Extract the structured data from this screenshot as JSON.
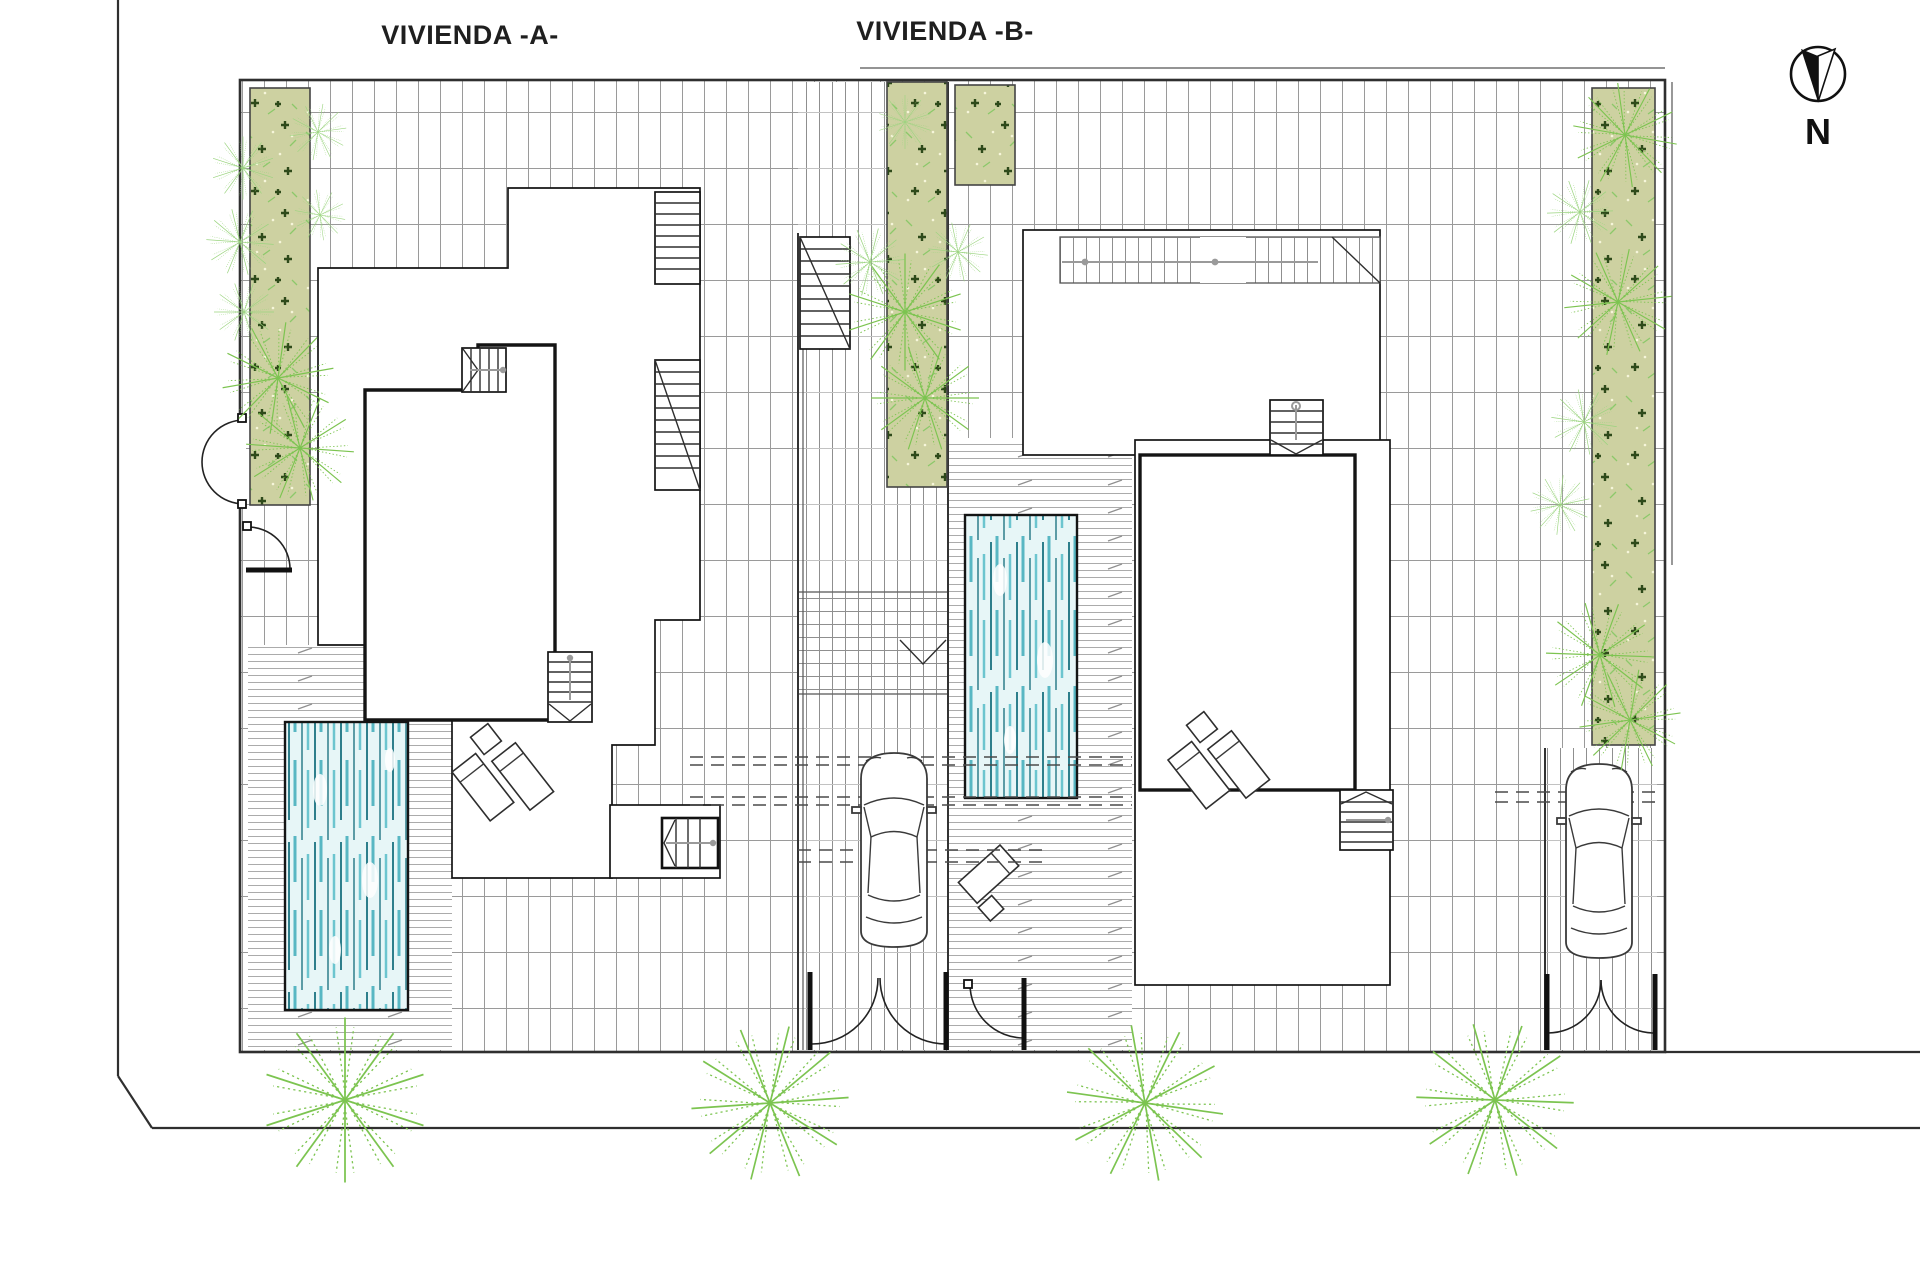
{
  "labels": {
    "vivienda_a": "VIVIENDA -A-",
    "vivienda_b": "VIVIENDA -B-"
  },
  "compass": {
    "label": "N"
  },
  "colors": {
    "wall": "#141414",
    "boundary": "#2f2f2f",
    "grid-line": "#9a9a9a",
    "deck-line": "#ababab",
    "green-fill": "#cdd1a1",
    "plant-dark": "#2e4a1a",
    "plant-light": "#9ad47e",
    "palm": "#7cc450",
    "pool-water": "#e7f6f7",
    "pool-stripe-dark": "#2e7f8c",
    "pool-stripe-light": "#58b7c3",
    "dashed": "#4a4a4a"
  }
}
